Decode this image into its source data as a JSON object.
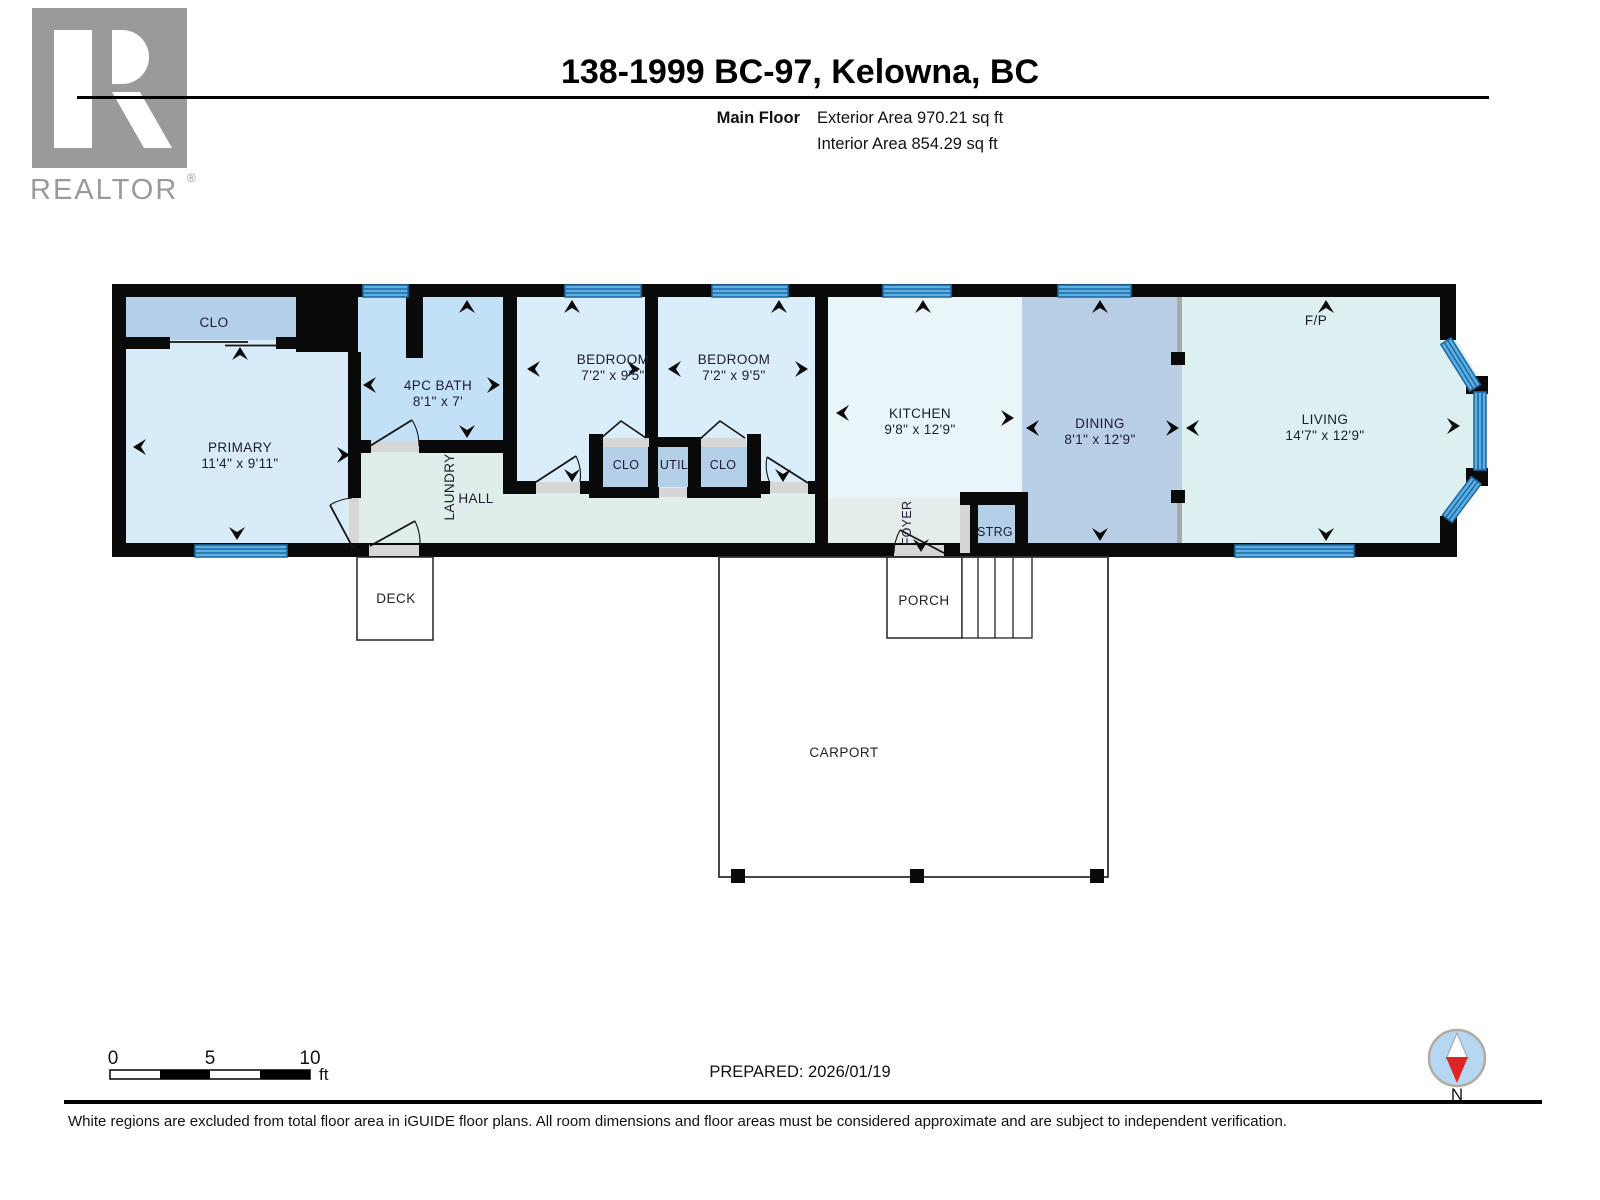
{
  "header": {
    "logo_brand": "REALTOR",
    "logo_reg": "®",
    "title": "138-1999 BC-97, Kelowna, BC",
    "floor_label": "Main Floor",
    "exterior_area": "Exterior Area 970.21 sq ft",
    "interior_area": "Interior Area 854.29 sq ft"
  },
  "rooms": {
    "clo_primary": {
      "label": "CLO"
    },
    "primary": {
      "label": "PRIMARY",
      "dims": "11'4\" x 9'11\""
    },
    "bath": {
      "label": "4PC BATH",
      "dims": "8'1\" x 7'"
    },
    "laundry": {
      "label": "LAUNDRY"
    },
    "hall": {
      "label": "HALL"
    },
    "bedroom1": {
      "label": "BEDROOM",
      "dims": "7'2\" x 9'5\""
    },
    "bedroom2": {
      "label": "BEDROOM",
      "dims": "7'2\" x 9'5\""
    },
    "clo1": {
      "label": "CLO"
    },
    "util": {
      "label": "UTIL"
    },
    "clo2": {
      "label": "CLO"
    },
    "kitchen": {
      "label": "KITCHEN",
      "dims": "9'8\" x 12'9\""
    },
    "foyer": {
      "label": "FOYER"
    },
    "strg": {
      "label": "STRG"
    },
    "dining": {
      "label": "DINING",
      "dims": "8'1\" x 12'9\""
    },
    "living": {
      "label": "LIVING",
      "dims": "14'7\" x 12'9\""
    },
    "fireplace": {
      "label": "F/P"
    },
    "deck": {
      "label": "DECK"
    },
    "porch": {
      "label": "PORCH"
    },
    "carport": {
      "label": "CARPORT"
    }
  },
  "footer": {
    "scale_ticks": [
      "0",
      "5",
      "10"
    ],
    "scale_unit": "ft",
    "prepared": "PREPARED: 2026/01/19",
    "compass_label": "N",
    "disclaimer": "White regions are excluded from total floor area in iGUIDE floor plans. All room dimensions and floor areas must be considered approximate and are subject to independent verification."
  },
  "colors": {
    "wall": "#0a0a0a",
    "window_fill": "#5fb0e1",
    "window_stroke": "#1c6ca9",
    "threshold_gray": "#d6d6d6",
    "post_gray": "#a8a8a8",
    "room_clo": "#b4d0e8",
    "room_primary": "#d7ebf8",
    "room_bath": "#c3e1f6",
    "room_bed": "#d9edfa",
    "room_hall": "#dfeeea",
    "room_kitchen": "#e9f5f9",
    "room_foyer": "#e4edeb",
    "room_dining": "#b8cfe6",
    "room_living": "#dcf0f1",
    "room_small": "#b4d0e8",
    "compass_blue": "#b5d7f2",
    "compass_red": "#dd2525",
    "logo_gray": "#9a9a9a"
  }
}
